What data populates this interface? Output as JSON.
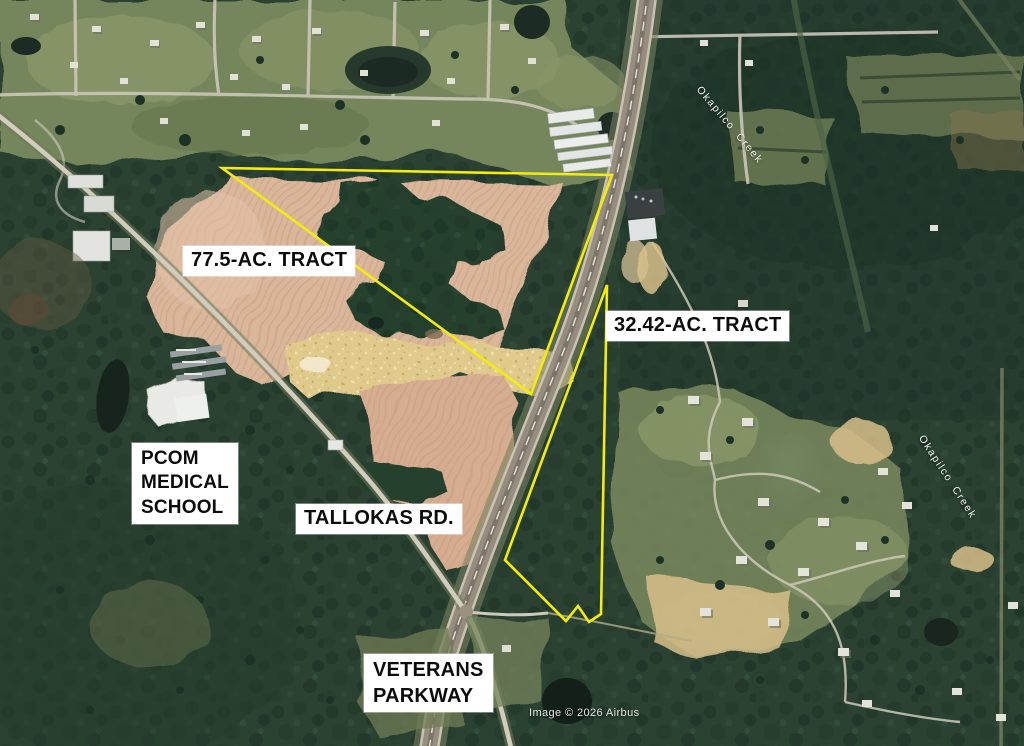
{
  "map": {
    "description": "Aerial satellite view of land tracts for sale along Veterans Parkway and Tallokas Rd.",
    "attribution": {
      "text": "Image © 2026 Airbus",
      "text_color": "#e4e6e2"
    },
    "creek_labels": [
      {
        "text": "Okapilco Creek"
      },
      {
        "text": "Okapilco Creek"
      }
    ]
  },
  "annotations": {
    "outline_color": "#f2ec0f",
    "label_bg": "#ffffff",
    "label_text_color": "#0c0c0c",
    "tracts": [
      {
        "label": "77.5-AC. TRACT",
        "outline_points": "222,168 612,175 531,394"
      },
      {
        "label": "32.42-AC. TRACT",
        "outline_points": "607,285 601,614 589,622 578,606 566,621 505,560"
      }
    ],
    "place_labels": {
      "pcom": {
        "line1": "PCOM",
        "line2": "MEDICAL",
        "line3": "SCHOOL"
      },
      "tallokas": {
        "text": "TALLOKAS RD."
      },
      "veterans": {
        "line1": "VETERANS",
        "line2": "PARKWAY"
      }
    }
  }
}
